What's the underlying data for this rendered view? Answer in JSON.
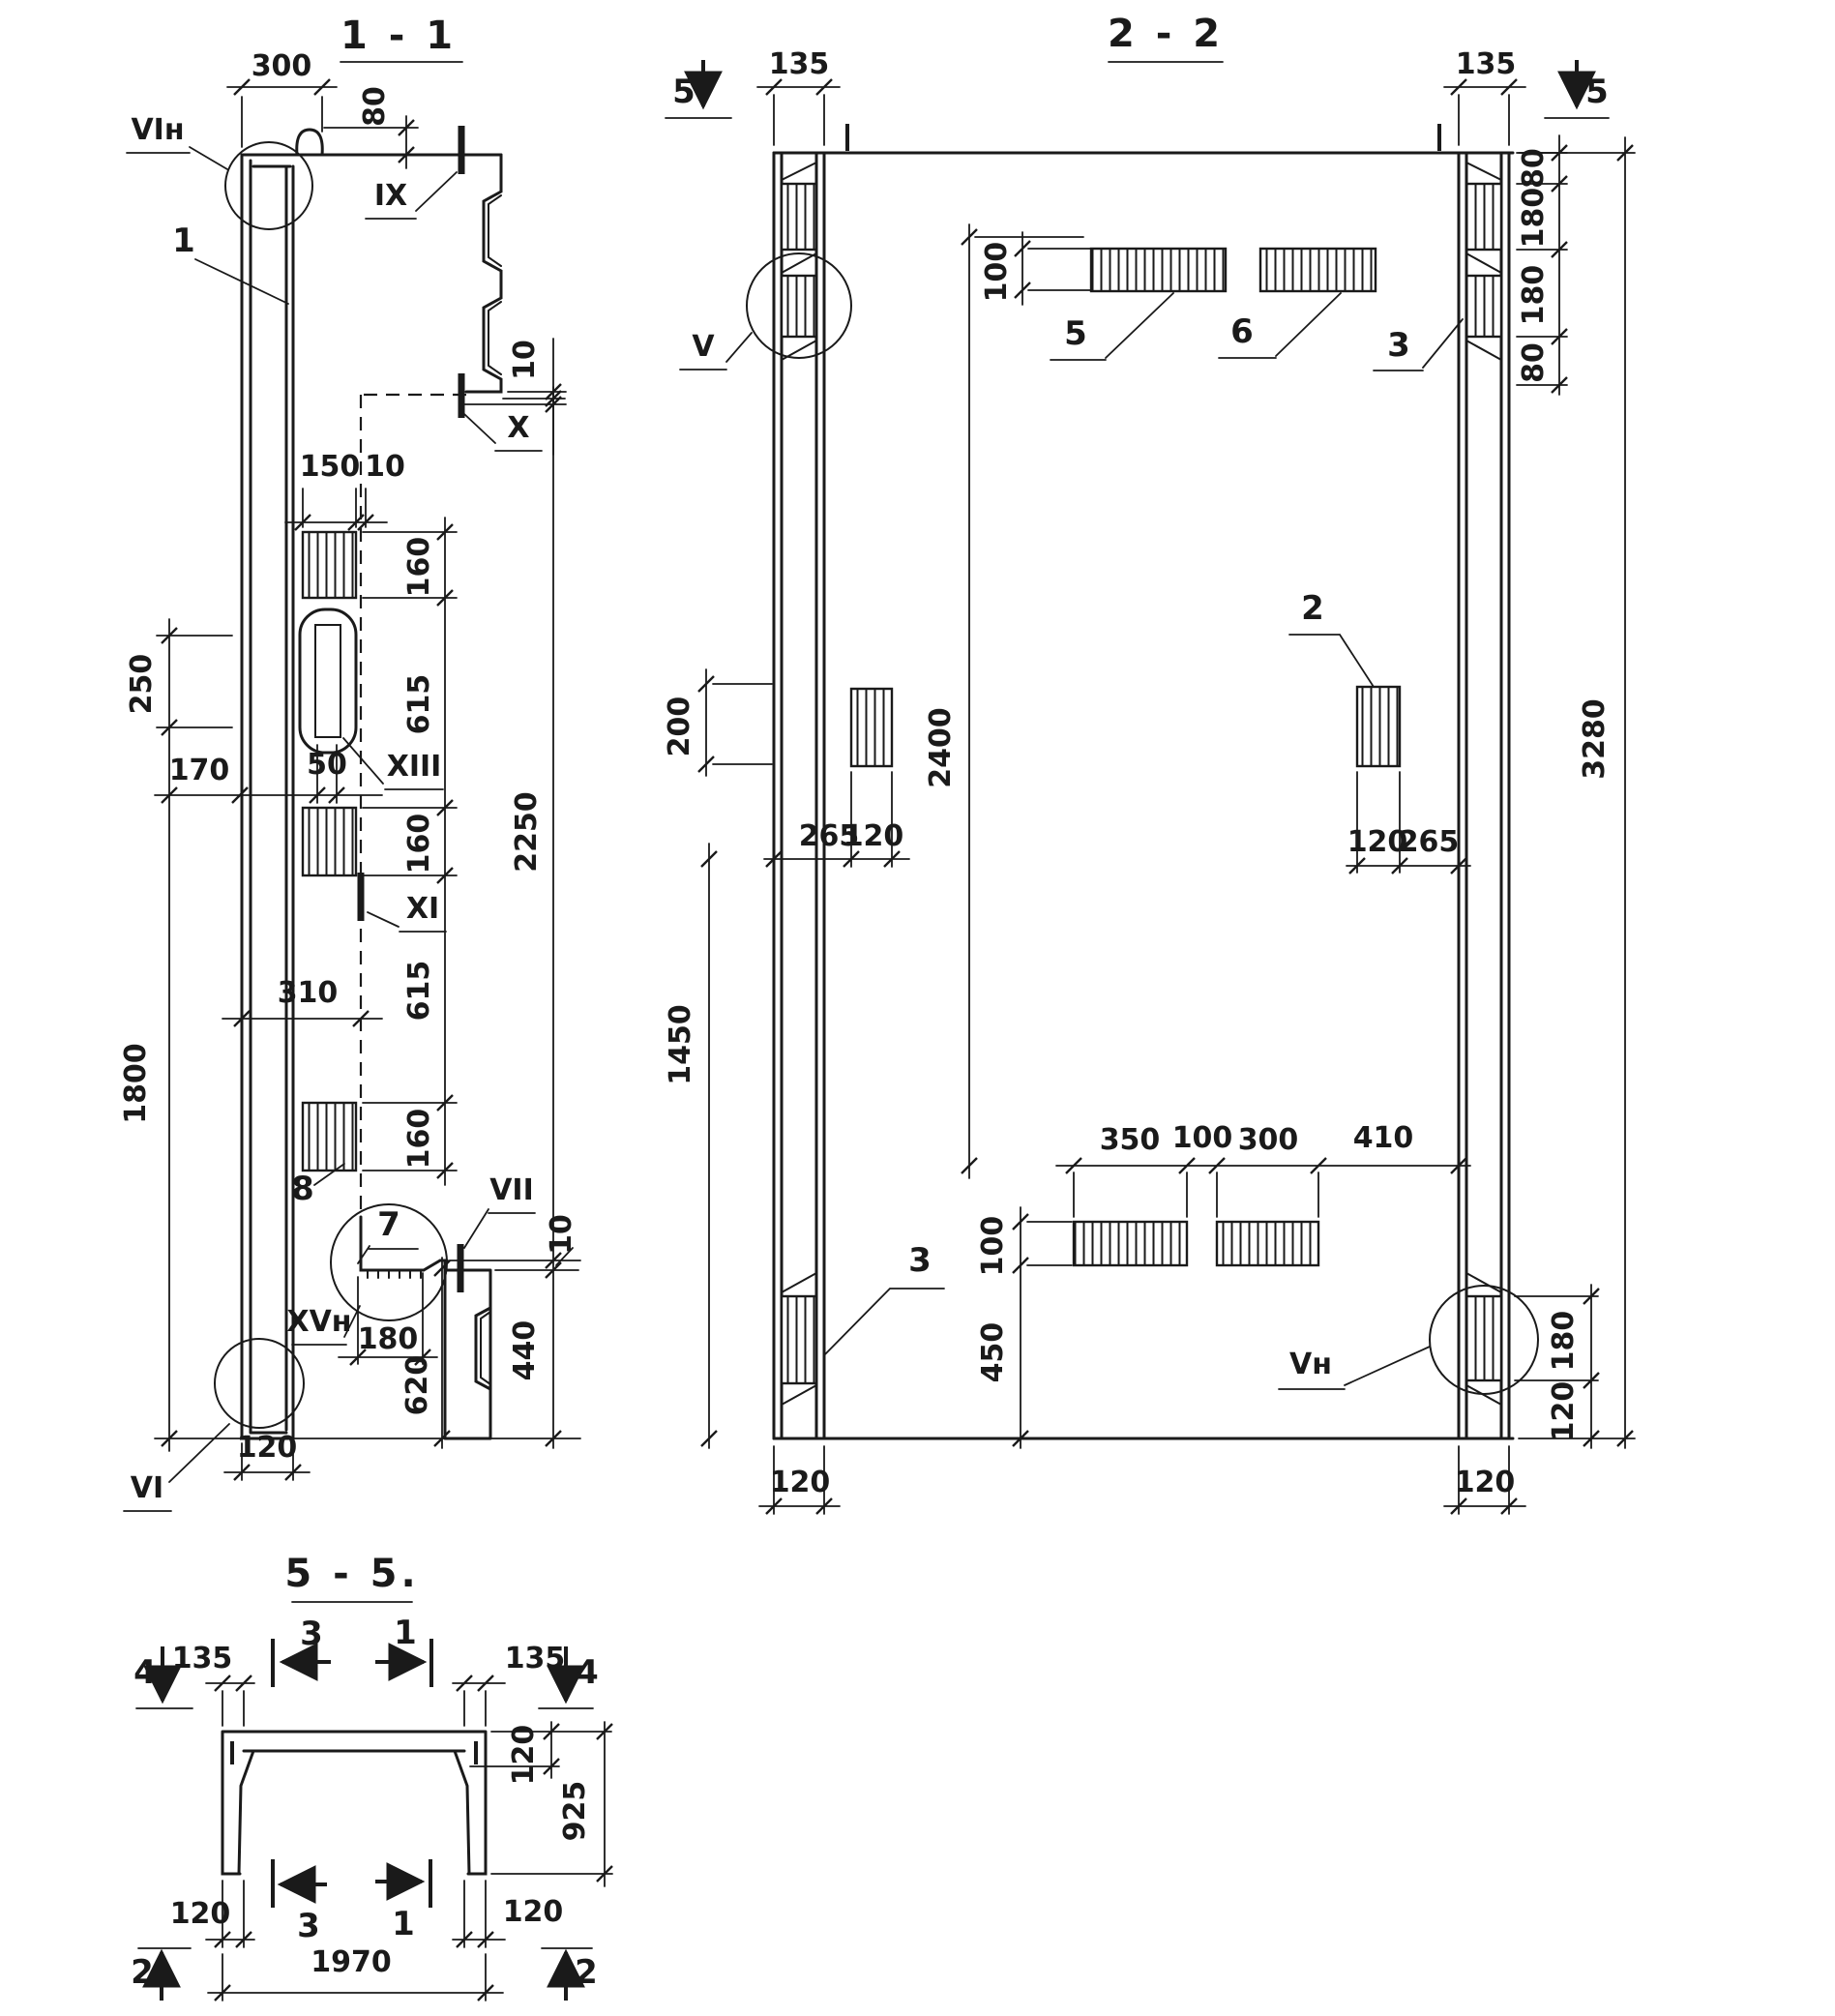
{
  "meta": {
    "background": "#ffffff",
    "ink": "#1a1a1a"
  },
  "s11": {
    "title": "1 - 1",
    "labels": {
      "vin": "VIн",
      "l1": "1",
      "ix": "IX",
      "x": "X",
      "xiii": "XIII",
      "xi": "XI",
      "l8": "8",
      "l7": "7",
      "vii": "VII",
      "xvn": "XVн",
      "vi": "VI"
    },
    "dims": {
      "d300": "300",
      "d80": "80",
      "d10a": "10",
      "d150": "150",
      "d10b": "10",
      "d160a": "160",
      "d615a": "615",
      "d160b": "160",
      "d615b": "615",
      "d160c": "160",
      "d2250": "2250",
      "d10c": "10",
      "d440": "440",
      "d620": "620",
      "d180": "180",
      "d250": "250",
      "d170": "170",
      "d50": "50",
      "d310": "310",
      "d1800": "1800",
      "d120": "120"
    }
  },
  "s22": {
    "title": "2 - 2",
    "labels": {
      "v": "V",
      "vn": "Vн",
      "p5": "5",
      "p6": "6",
      "p2": "2",
      "r3": "3",
      "l3": "3",
      "cut5l": "5",
      "cut5r": "5"
    },
    "dims": {
      "d135l": "135",
      "d135r": "135",
      "d80a": "80",
      "d180a": "180",
      "d180b": "180",
      "d80b": "80",
      "d100t": "100",
      "d200": "200",
      "d265l": "265",
      "d120l": "120",
      "d120r": "120",
      "d265r": "265",
      "d2400": "2400",
      "d3280": "3280",
      "d1450": "1450",
      "d350": "350",
      "d100m": "100",
      "d300": "300",
      "d410": "410",
      "d100b": "100",
      "d450": "450",
      "d180r": "180",
      "d120rb": "120",
      "d120cl": "120",
      "d120cr": "120"
    }
  },
  "s55": {
    "title": "5 - 5.",
    "marks": {
      "m4l": "4",
      "m4r": "4",
      "m3t": "3",
      "m1t": "1",
      "m3b": "3",
      "m1b": "1",
      "m2l": "2",
      "m2r": "2"
    },
    "dims": {
      "d135l": "135",
      "d135r": "135",
      "d120t": "120",
      "d925": "925",
      "d120bl": "120",
      "d120br": "120",
      "d1970": "1970"
    }
  }
}
